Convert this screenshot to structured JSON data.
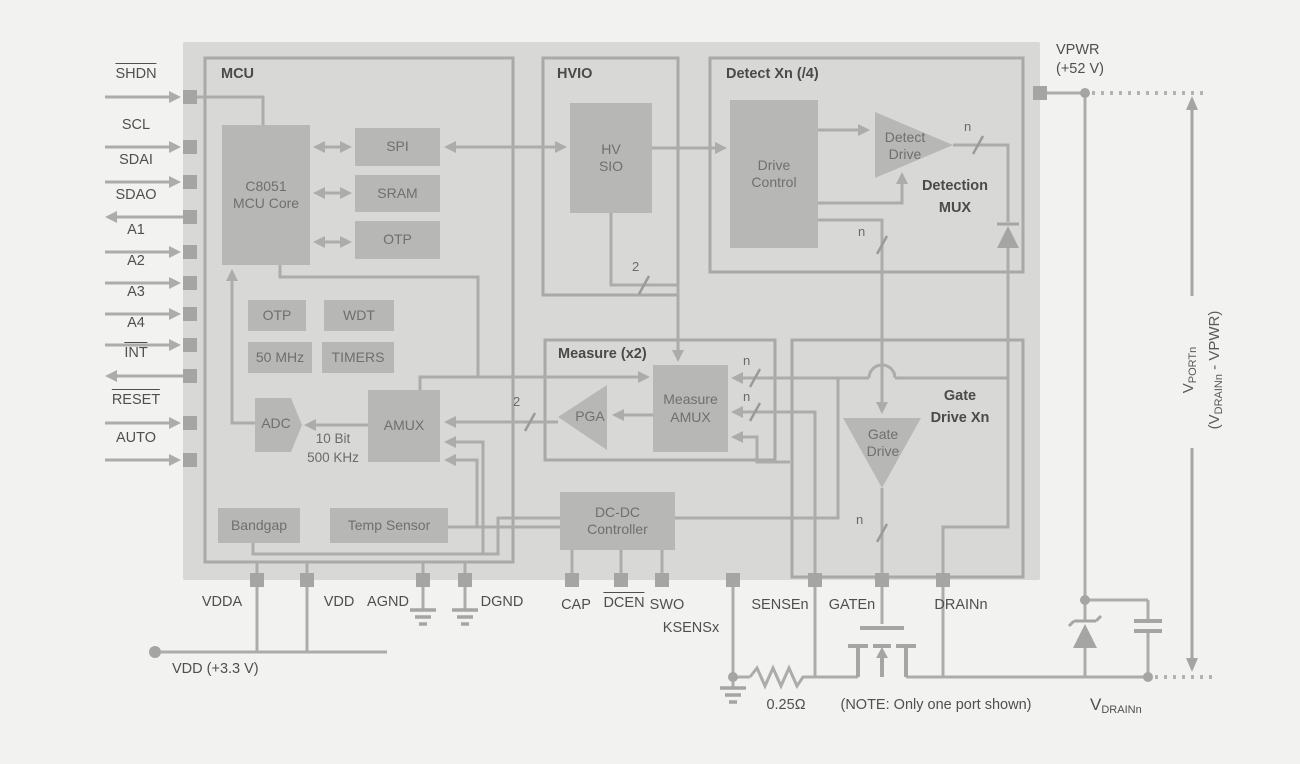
{
  "colors": {
    "background": "#f2f2f1",
    "chip_body": "#d8d8d7",
    "box_border": "#a9a9a8",
    "block_fill": "#b7b7b6",
    "wire": "#acacab",
    "pin": "#a5a5a4",
    "label_text": "#4f4f4f"
  },
  "pins": {
    "left": [
      {
        "label": "SHDN",
        "active_low": true,
        "direction": "in"
      },
      {
        "label": "SCL",
        "active_low": false,
        "direction": "in"
      },
      {
        "label": "SDAI",
        "active_low": false,
        "direction": "in"
      },
      {
        "label": "SDAO",
        "active_low": false,
        "direction": "out"
      },
      {
        "label": "A1",
        "active_low": false,
        "direction": "in"
      },
      {
        "label": "A2",
        "active_low": false,
        "direction": "in"
      },
      {
        "label": "A3",
        "active_low": false,
        "direction": "in"
      },
      {
        "label": "A4",
        "active_low": false,
        "direction": "in"
      },
      {
        "label": "INT",
        "active_low": true,
        "direction": "out"
      },
      {
        "label": "RESET",
        "active_low": true,
        "direction": "in"
      },
      {
        "label": "AUTO",
        "active_low": false,
        "direction": "in"
      }
    ],
    "bottom": [
      "VDDA",
      "VDD",
      "AGND",
      "DGND",
      "CAP",
      "DCEN",
      "SWO",
      "KSENSx",
      "SENSEn",
      "GATEn",
      "DRAINn"
    ],
    "right_top": {
      "line1": "VPWR",
      "line2": "(+52 V)"
    }
  },
  "boxes": {
    "mcu": "MCU",
    "hvio": "HVIO",
    "detect": "Detect Xn (/4)",
    "measure": "Measure (x2)",
    "gate_drive": "Gate\nDrive Xn",
    "detection_mux": "Detection\nMUX"
  },
  "blocks": {
    "c8051": "C8051\nMCU Core",
    "spi": "SPI",
    "sram": "SRAM",
    "otp_top": "OTP",
    "otp_small": "OTP",
    "wdt": "WDT",
    "clock": "50 MHz",
    "timers": "TIMERS",
    "adc": "ADC",
    "amux": "AMUX",
    "bandgap": "Bandgap",
    "temp_sensor": "Temp Sensor",
    "hv_sio": "HV\nSIO",
    "drive_control": "Drive\nControl",
    "detect_drive": "Detect\nDrive",
    "measure_amux": "Measure\nAMUX",
    "pga": "PGA",
    "gate_drive": "Gate\nDrive",
    "dcdc": "DC-DC\nController"
  },
  "annotations": {
    "adc_spec": "10 Bit\n500 KHz",
    "bus_width_2": "2",
    "bus_width_n": "n",
    "sense_resistor": "0.25Ω",
    "note": "(NOTE: Only one port shown)",
    "vdd_supply": "VDD (+3.3 V)"
  },
  "voltages": {
    "vport": {
      "v": "V",
      "sub": "PORTn"
    },
    "vport_paren": {
      "pre": "(V",
      "sub": "DRAINn",
      "post": " - VPWR)"
    },
    "vdrain": {
      "v": "V",
      "sub": "DRAINn"
    }
  }
}
